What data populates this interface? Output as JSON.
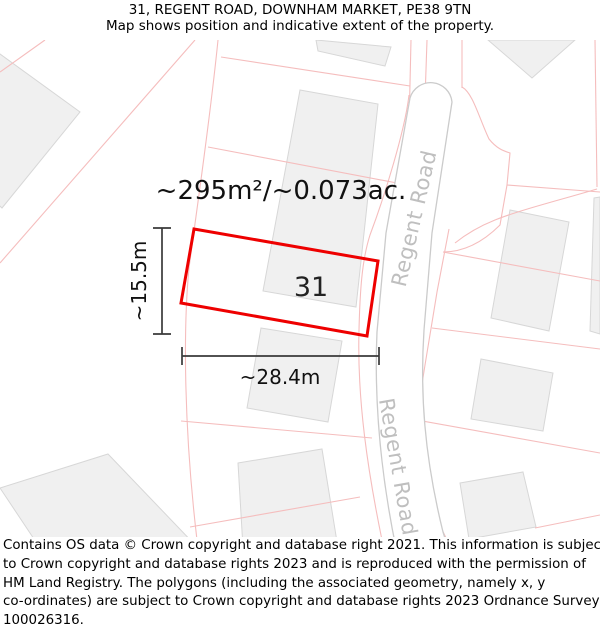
{
  "header": {
    "title": "31, REGENT ROAD, DOWNHAM MARKET, PE38 9TN",
    "subtitle": "Map shows position and indicative extent of the property."
  },
  "map": {
    "plot_number": "31",
    "area_label": "~295m²/~0.073ac.",
    "width_label": "~28.4m",
    "height_label": "~15.5m",
    "road_label_upper": "Regent Road",
    "road_label_lower": "Regent Road",
    "colors": {
      "highlight": "#ee0000",
      "parcel_line": "#f5bdbd",
      "building_fill": "#f0f0f0",
      "building_stroke": "#d7d7d7",
      "road_fill": "#ffffff",
      "road_edge": "#cbcbcb",
      "road_label": "#bfbfbf",
      "dimension": "#3a3a3a"
    }
  },
  "footer": {
    "lines": [
      "Contains OS data © Crown copyright and database right 2021. This information is subject",
      "to Crown copyright and database rights 2023 and is reproduced with the permission of",
      "HM Land Registry. The polygons (including the associated geometry, namely x, y",
      "co-ordinates) are subject to Crown copyright and database rights 2023 Ordnance Survey",
      "100026316."
    ]
  }
}
